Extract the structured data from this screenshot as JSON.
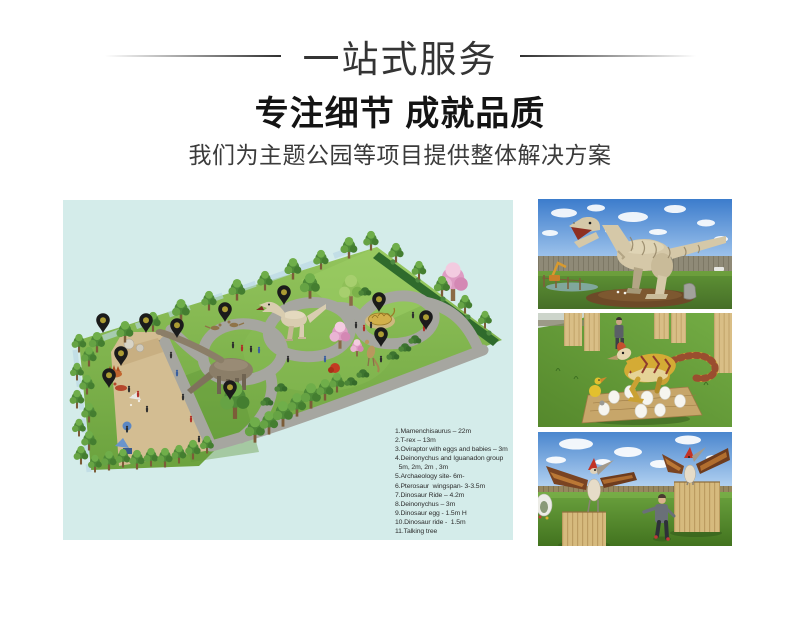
{
  "header": {
    "banner_title": "一站式服务",
    "headline": "专注细节 成就品质",
    "subheadline": "我们为主题公园等项目提供整体解决方案"
  },
  "map": {
    "background_color": "#d4ecea",
    "pin_color": "#1b1b1b",
    "pin_dot_color": "#ac9c33",
    "marker_count": 11,
    "legend_items": [
      "1.Mamenchisaurus – 22m",
      "2.T-rex – 13m",
      "3.Oviraptor with eggs and babies – 3m",
      "4.Deinonychus and Iguanadon group",
      "  5m, 2m, 2m , 3m",
      "5.Archaeology site- 6m-",
      "6.Pterosaur  wingspan- 3-3.5m",
      "7.Dinosaur Ride – 4.2m",
      "8.Deinonychus – 3m",
      "9.Dinosaur egg - 1.5m H",
      "10.Dinosaur ride -  1.5m",
      "11.Talking tree"
    ]
  },
  "gallery": {
    "photo_count": 3,
    "photos": [
      {
        "name": "t-rex animatronic model"
      },
      {
        "name": "oviraptor with eggs"
      },
      {
        "name": "pterosaur models"
      }
    ]
  }
}
